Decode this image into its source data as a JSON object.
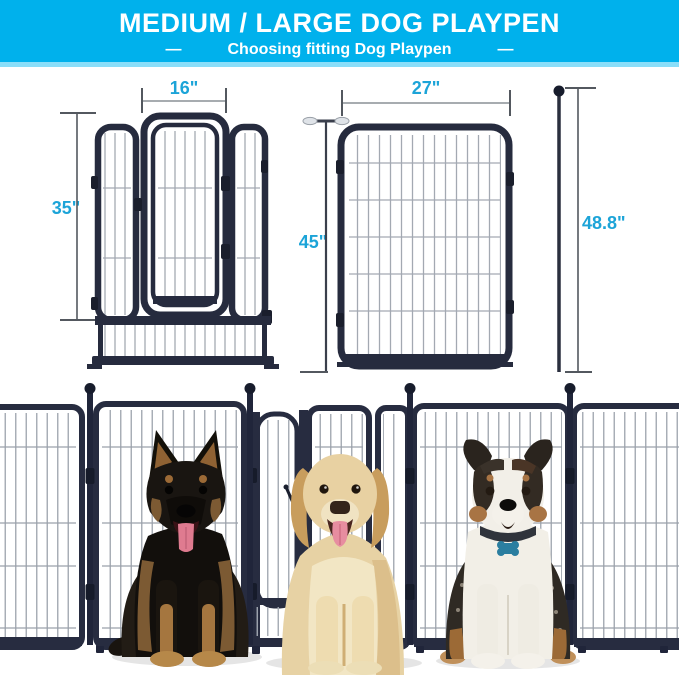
{
  "header": {
    "title": "MEDIUM / LARGE DOG PLAYPEN",
    "subtitle": "Choosing fitting Dog Playpen",
    "dash": "—"
  },
  "dimensions": {
    "gate_width": "16\"",
    "medium_panel_height": "35\"",
    "large_panel_width": "27\"",
    "large_panel_height": "45\"",
    "pole_length": "48.8\""
  },
  "colors": {
    "header_bg": "#00b1ec",
    "header_text": "#ffffff",
    "dimension_label": "#1ca4d8",
    "frame": "#272c40",
    "wire": "#a3a9b2",
    "tag_teal": "#2b7ea0"
  }
}
